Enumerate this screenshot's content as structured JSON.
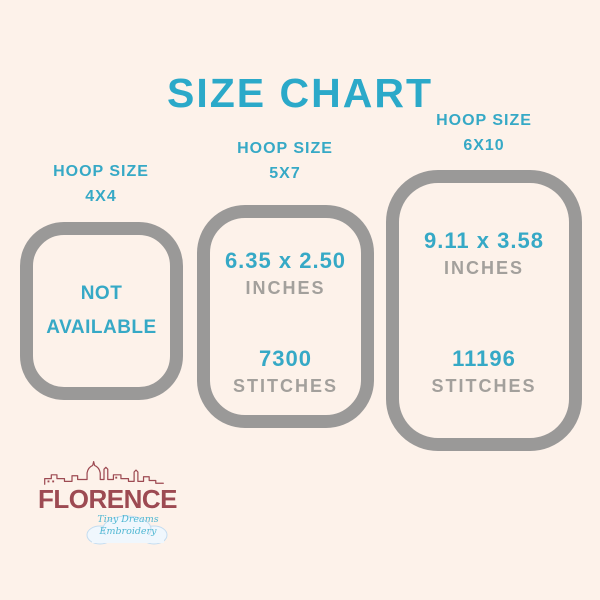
{
  "title": "SIZE CHART",
  "colors": {
    "background": "#fdf2ea",
    "teal": "#36a9c6",
    "hoop_border_gray": "#9a9998",
    "text_gray": "#a3a09c",
    "logo_maroon": "#9d4a52"
  },
  "hoops": [
    {
      "label_line1": "HOOP SIZE",
      "label_line2": "4X4",
      "available": false,
      "na_line1": "NOT",
      "na_line2": "AVAILABLE"
    },
    {
      "label_line1": "HOOP SIZE",
      "label_line2": "5X7",
      "available": true,
      "size_inches": "6.35 x 2.50",
      "unit_label": "INCHES",
      "stitches": "7300",
      "stitches_label": "STITCHES"
    },
    {
      "label_line1": "HOOP SIZE",
      "label_line2": "6X10",
      "available": true,
      "size_inches": "9.11 x 3.58",
      "unit_label": "INCHES",
      "stitches": "11196",
      "stitches_label": "STITCHES"
    }
  ],
  "logo": {
    "name": "FLORENCE",
    "tagline_line1": "Tiny Dreams",
    "tagline_line2": "Embroidery"
  }
}
